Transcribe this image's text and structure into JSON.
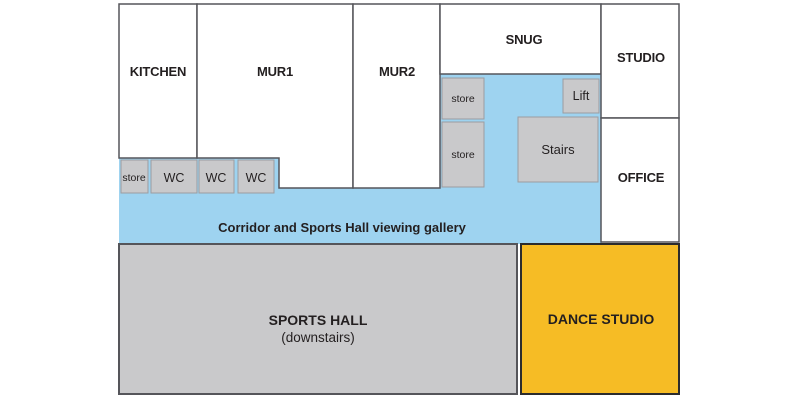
{
  "colors": {
    "corridor": "#9ED3F0",
    "room_fill": "#FFFFFF",
    "wall": "#55555A",
    "gray_box": "#C9C9CB",
    "gray_box_border": "#9C9CA0",
    "hall_border": "#55555A",
    "dance": "#F6BC25",
    "dance_border": "#2B2B2D",
    "text": "#231F20"
  },
  "rooms": {
    "kitchen": "KITCHEN",
    "mur1": "MUR1",
    "mur2": "MUR2",
    "snug": "SNUG",
    "studio": "STUDIO",
    "office": "OFFICE"
  },
  "facilities": {
    "store_row": "store",
    "wc": [
      "WC",
      "WC",
      "WC"
    ],
    "store_upper": "store",
    "store_lower": "store",
    "lift": "Lift",
    "stairs": "Stairs"
  },
  "corridor": {
    "label": "Corridor and Sports Hall viewing gallery"
  },
  "sports_hall": {
    "label": "SPORTS HALL",
    "sublabel": "(downstairs)"
  },
  "dance_studio": {
    "label": "DANCE STUDIO"
  }
}
